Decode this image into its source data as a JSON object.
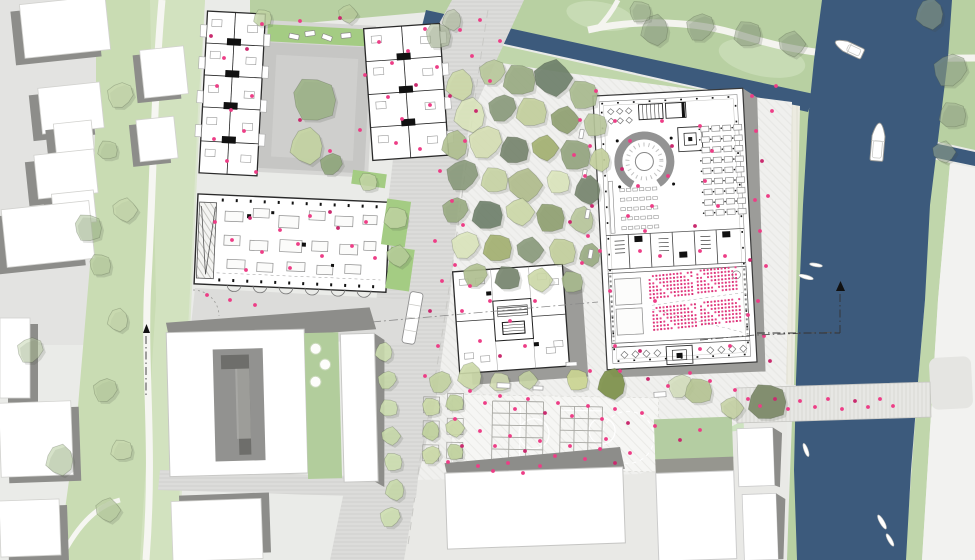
{
  "title": "urban-masterplan-site-plan",
  "colors": {
    "water": "#3c5a7c",
    "lawn_north": "#b8d0a2",
    "lawn_light": "#cfe0bf",
    "bank_south": "#c0d6ab",
    "green_strip": "#c9dcb3",
    "green_strip_light": "#d6e4c5",
    "bed_green": "#a4cc83",
    "lawn_se": "#cde3c0",
    "ground": "#eaebe8",
    "context_ground": "#e3e3e1",
    "bottom_ground": "#e9e9e6",
    "road_olive": "#a5a79c",
    "white_building": "#ffffff",
    "shadow": "#8d8d8a",
    "shadow_light": "#9c9c99",
    "courtyard_gray": "#c6c6c4",
    "courtyard_dark": "#6e6e6b",
    "roof_green": "#b4cda2",
    "people": "#ed3d86",
    "people_dark": "#c92a6e",
    "seat_a": "#e8488a",
    "seat_b": "#d92f75",
    "boat_fill": "#ffffff",
    "boat_stroke": "#9a9a96",
    "path_white": "#f6f6f2",
    "tree_shadow": "#44483e",
    "furniture_stroke": "#9a9a9a"
  },
  "trees": [
    [
      460,
      85,
      16,
      "#cdd9a8",
      0.9
    ],
    [
      492,
      72,
      14,
      "#b9c99b",
      0.9
    ],
    [
      520,
      80,
      18,
      "#99ab82",
      0.9
    ],
    [
      553,
      78,
      20,
      "#6e7f6a",
      0.9
    ],
    [
      583,
      95,
      16,
      "#a9ba8e",
      0.9
    ],
    [
      470,
      115,
      18,
      "#dce6bd",
      0.9
    ],
    [
      502,
      108,
      15,
      "#8a9a7b",
      0.9
    ],
    [
      532,
      112,
      17,
      "#c3cf9c",
      0.9
    ],
    [
      565,
      120,
      15,
      "#8fa070",
      0.9
    ],
    [
      595,
      125,
      13,
      "#b8c79b",
      0.9
    ],
    [
      455,
      145,
      15,
      "#b0c090",
      0.9
    ],
    [
      485,
      142,
      18,
      "#d6dfb4",
      0.9
    ],
    [
      515,
      150,
      16,
      "#75846d",
      0.9
    ],
    [
      545,
      148,
      14,
      "#a3b070",
      0.9
    ],
    [
      575,
      155,
      17,
      "#93a47e",
      0.9
    ],
    [
      600,
      160,
      12,
      "#c3cf9c",
      0.9
    ],
    [
      462,
      175,
      17,
      "#8a9a7b",
      0.9
    ],
    [
      495,
      180,
      15,
      "#c8d4a4",
      0.9
    ],
    [
      525,
      185,
      18,
      "#b0bd8c",
      0.9
    ],
    [
      558,
      182,
      13,
      "#dce6bd",
      0.9
    ],
    [
      588,
      190,
      15,
      "#75846d",
      0.9
    ],
    [
      455,
      210,
      14,
      "#99ab82",
      0.9
    ],
    [
      488,
      215,
      17,
      "#6e7f6a",
      0.9
    ],
    [
      520,
      212,
      15,
      "#cdd9a8",
      0.9
    ],
    [
      550,
      218,
      16,
      "#8fa070",
      0.9
    ],
    [
      582,
      220,
      14,
      "#b8c79b",
      0.9
    ],
    [
      465,
      245,
      15,
      "#dce6bd",
      0.9
    ],
    [
      498,
      248,
      16,
      "#a3b070",
      0.9
    ],
    [
      530,
      250,
      14,
      "#8a9a7b",
      0.9
    ],
    [
      562,
      252,
      15,
      "#c3cf9c",
      0.9
    ],
    [
      590,
      255,
      12,
      "#99ab82",
      0.9
    ],
    [
      475,
      275,
      13,
      "#b0c090",
      0.9
    ],
    [
      508,
      278,
      14,
      "#75846d",
      0.9
    ],
    [
      540,
      280,
      13,
      "#cdd9a8",
      0.9
    ],
    [
      572,
      282,
      12,
      "#a9ba8e",
      0.9
    ],
    [
      655,
      30,
      16,
      "#93a488",
      0.55
    ],
    [
      700,
      27,
      15,
      "#93a488",
      0.5
    ],
    [
      748,
      34,
      15,
      "#8f9f84",
      0.5
    ],
    [
      792,
      44,
      14,
      "#93a488",
      0.5
    ],
    [
      640,
      12,
      12,
      "#a2b194",
      0.45
    ],
    [
      930,
      14,
      16,
      "#9aa98c",
      0.5
    ],
    [
      950,
      70,
      18,
      "#96a78a",
      0.55
    ],
    [
      953,
      115,
      15,
      "#9aa98c",
      0.5
    ],
    [
      944,
      152,
      12,
      "#a2b194",
      0.5
    ],
    [
      438,
      36,
      14,
      "#a8b896",
      0.6
    ],
    [
      452,
      20,
      11,
      "#b2c19e",
      0.55
    ],
    [
      120,
      95,
      14,
      "#c7d8ae",
      0.75
    ],
    [
      108,
      150,
      11,
      "#b9cda1",
      0.75
    ],
    [
      125,
      210,
      13,
      "#c7d8ae",
      0.75
    ],
    [
      100,
      265,
      12,
      "#b9cda1",
      0.75
    ],
    [
      118,
      320,
      12,
      "#c7d8ae",
      0.75
    ],
    [
      105,
      390,
      13,
      "#b9cda1",
      0.75
    ],
    [
      122,
      450,
      12,
      "#c7d8ae",
      0.75
    ],
    [
      108,
      510,
      13,
      "#b9cda1",
      0.75
    ],
    [
      88,
      228,
      15,
      "#a3bb8e",
      0.5
    ],
    [
      60,
      460,
      16,
      "#aec694",
      0.5
    ],
    [
      30,
      350,
      14,
      "#b7cc9f",
      0.45
    ],
    [
      263,
      18,
      10,
      "#c2d4a4",
      0.8
    ],
    [
      348,
      14,
      10,
      "#bccf9e",
      0.7
    ],
    [
      314,
      100,
      24,
      "#9cb287",
      0.9
    ],
    [
      307,
      146,
      19,
      "#c4d4a2",
      0.9
    ],
    [
      331,
      164,
      12,
      "#90a67c",
      0.9
    ],
    [
      396,
      218,
      13,
      "#bed3a0",
      0.9
    ],
    [
      398,
      256,
      12,
      "#b5cc98",
      0.9
    ],
    [
      368,
      182,
      10,
      "#c4d6a6",
      0.85
    ],
    [
      470,
      376,
      14,
      "#ccd9a8",
      0.9
    ],
    [
      440,
      382,
      12,
      "#c2d2a0",
      0.9
    ],
    [
      500,
      382,
      11,
      "#d2ddb2",
      0.85
    ],
    [
      528,
      380,
      10,
      "#c6d4a2",
      0.85
    ],
    [
      577,
      380,
      12,
      "#ccd692",
      0.9
    ],
    [
      612,
      384,
      16,
      "#81934f",
      0.95
    ],
    [
      680,
      386,
      13,
      "#d4debc",
      0.85
    ],
    [
      699,
      391,
      15,
      "#b6c493",
      0.9
    ],
    [
      732,
      408,
      12,
      "#c2cf9e",
      0.8
    ],
    [
      431,
      407,
      10,
      "#cbd9a6",
      0.9
    ],
    [
      431,
      431,
      10,
      "#c0d29c",
      0.9
    ],
    [
      431,
      455,
      10,
      "#cbd9a6",
      0.9
    ],
    [
      455,
      403,
      10,
      "#c0d29c",
      0.9
    ],
    [
      455,
      428,
      10,
      "#cbd9a6",
      0.9
    ],
    [
      455,
      452,
      9,
      "#c0d29c",
      0.9
    ],
    [
      384,
      352,
      10,
      "#cfe0b0",
      0.85
    ],
    [
      387,
      380,
      10,
      "#c8dba8",
      0.85
    ],
    [
      389,
      408,
      10,
      "#cfe0b0",
      0.85
    ],
    [
      391,
      436,
      10,
      "#c8dba8",
      0.85
    ],
    [
      393,
      462,
      10,
      "#cfe0b0",
      0.85
    ],
    [
      395,
      490,
      11,
      "#c8dba8",
      0.85
    ],
    [
      390,
      517,
      11,
      "#cfe0b0",
      0.85
    ],
    [
      768,
      402,
      21,
      "#7d8a6a",
      0.95
    ]
  ],
  "people": [
    [
      211,
      36
    ],
    [
      224,
      58
    ],
    [
      217,
      86
    ],
    [
      231,
      110
    ],
    [
      214,
      139
    ],
    [
      227,
      161
    ],
    [
      247,
      49
    ],
    [
      252,
      96
    ],
    [
      244,
      131
    ],
    [
      256,
      172
    ],
    [
      262,
      24
    ],
    [
      300,
      21
    ],
    [
      340,
      18
    ],
    [
      379,
      42
    ],
    [
      392,
      63
    ],
    [
      408,
      51
    ],
    [
      388,
      97
    ],
    [
      402,
      119
    ],
    [
      416,
      85
    ],
    [
      430,
      105
    ],
    [
      396,
      143
    ],
    [
      420,
      149
    ],
    [
      437,
      67
    ],
    [
      425,
      29
    ],
    [
      300,
      120
    ],
    [
      330,
      151
    ],
    [
      360,
      130
    ],
    [
      365,
      75
    ],
    [
      215,
      222
    ],
    [
      232,
      240
    ],
    [
      250,
      218
    ],
    [
      262,
      252
    ],
    [
      280,
      230
    ],
    [
      298,
      244
    ],
    [
      310,
      216
    ],
    [
      322,
      256
    ],
    [
      338,
      228
    ],
    [
      352,
      246
    ],
    [
      366,
      222
    ],
    [
      375,
      258
    ],
    [
      290,
      268
    ],
    [
      246,
      270
    ],
    [
      330,
      212
    ],
    [
      207,
      295
    ],
    [
      230,
      300
    ],
    [
      255,
      305
    ],
    [
      460,
      30
    ],
    [
      472,
      56
    ],
    [
      450,
      96
    ],
    [
      465,
      141
    ],
    [
      440,
      171
    ],
    [
      452,
      201
    ],
    [
      435,
      241
    ],
    [
      442,
      281
    ],
    [
      430,
      311
    ],
    [
      438,
      346
    ],
    [
      425,
      376
    ],
    [
      480,
      20
    ],
    [
      500,
      41
    ],
    [
      490,
      81
    ],
    [
      476,
      111
    ],
    [
      455,
      265
    ],
    [
      463,
      225
    ],
    [
      580,
      120
    ],
    [
      590,
      146
    ],
    [
      585,
      176
    ],
    [
      592,
      206
    ],
    [
      588,
      236
    ],
    [
      582,
      263
    ],
    [
      596,
      91
    ],
    [
      600,
      251
    ],
    [
      574,
      155
    ],
    [
      570,
      222
    ],
    [
      470,
      391
    ],
    [
      485,
      403
    ],
    [
      500,
      396
    ],
    [
      515,
      409
    ],
    [
      528,
      399
    ],
    [
      545,
      413
    ],
    [
      558,
      403
    ],
    [
      572,
      416
    ],
    [
      588,
      406
    ],
    [
      602,
      419
    ],
    [
      615,
      409
    ],
    [
      628,
      423
    ],
    [
      642,
      413
    ],
    [
      655,
      426
    ],
    [
      480,
      431
    ],
    [
      495,
      446
    ],
    [
      510,
      436
    ],
    [
      525,
      451
    ],
    [
      540,
      441
    ],
    [
      555,
      456
    ],
    [
      570,
      446
    ],
    [
      585,
      459
    ],
    [
      600,
      449
    ],
    [
      615,
      463
    ],
    [
      630,
      453
    ],
    [
      478,
      466
    ],
    [
      493,
      471
    ],
    [
      508,
      463
    ],
    [
      523,
      473
    ],
    [
      462,
      446
    ],
    [
      448,
      462
    ],
    [
      455,
      419
    ],
    [
      606,
      439
    ],
    [
      540,
      466
    ],
    [
      756,
      131
    ],
    [
      762,
      161
    ],
    [
      768,
      196
    ],
    [
      760,
      231
    ],
    [
      766,
      266
    ],
    [
      758,
      301
    ],
    [
      764,
      336
    ],
    [
      770,
      361
    ],
    [
      752,
      96
    ],
    [
      772,
      111
    ],
    [
      776,
      86
    ],
    [
      748,
      399
    ],
    [
      760,
      406
    ],
    [
      775,
      399
    ],
    [
      788,
      409
    ],
    [
      800,
      401
    ],
    [
      815,
      407
    ],
    [
      828,
      399
    ],
    [
      842,
      409
    ],
    [
      855,
      401
    ],
    [
      868,
      407
    ],
    [
      880,
      399
    ],
    [
      893,
      406
    ],
    [
      615,
      121
    ],
    [
      630,
      141
    ],
    [
      622,
      169
    ],
    [
      638,
      186
    ],
    [
      652,
      206
    ],
    [
      628,
      216
    ],
    [
      645,
      231
    ],
    [
      662,
      121
    ],
    [
      672,
      146
    ],
    [
      668,
      176
    ],
    [
      700,
      126
    ],
    [
      712,
      151
    ],
    [
      705,
      181
    ],
    [
      718,
      206
    ],
    [
      695,
      226
    ],
    [
      640,
      251
    ],
    [
      660,
      256
    ],
    [
      700,
      251
    ],
    [
      725,
      256
    ],
    [
      615,
      346
    ],
    [
      640,
      351
    ],
    [
      700,
      349
    ],
    [
      730,
      346
    ],
    [
      655,
      301
    ],
    [
      610,
      291
    ],
    [
      755,
      200
    ],
    [
      750,
      260
    ],
    [
      748,
      315
    ],
    [
      470,
      286
    ],
    [
      490,
      301
    ],
    [
      510,
      321
    ],
    [
      480,
      341
    ],
    [
      500,
      356
    ],
    [
      525,
      346
    ],
    [
      462,
      311
    ],
    [
      535,
      301
    ],
    [
      590,
      371
    ],
    [
      620,
      371
    ],
    [
      648,
      379
    ],
    [
      668,
      386
    ],
    [
      690,
      373
    ],
    [
      710,
      381
    ],
    [
      735,
      390
    ],
    [
      700,
      430
    ],
    [
      680,
      440
    ]
  ],
  "benches": [
    [
      497,
      383,
      13,
      5,
      2
    ],
    [
      533,
      386,
      10,
      4,
      2
    ],
    [
      654,
      392,
      12,
      5,
      -3
    ],
    [
      566,
      362,
      11,
      4,
      -3
    ],
    [
      577,
      132,
      9,
      4,
      -80
    ],
    [
      580,
      172,
      9,
      4,
      -80
    ],
    [
      583,
      212,
      9,
      4,
      -80
    ],
    [
      586,
      252,
      9,
      4,
      -80
    ]
  ],
  "cars": [
    [
      289,
      34,
      10,
      5,
      12
    ],
    [
      305,
      31,
      10,
      5,
      -8
    ],
    [
      322,
      35,
      10,
      5,
      20
    ],
    [
      341,
      33,
      10,
      5,
      -5
    ]
  ],
  "beds": [
    [
      384,
      200,
      24,
      46,
      8
    ],
    [
      388,
      248,
      24,
      42,
      8
    ],
    [
      352,
      172,
      34,
      14,
      8
    ]
  ],
  "context_buildings": [
    {
      "x": 22,
      "y": 0,
      "w": 86,
      "h": 54,
      "rot": -6,
      "ox": -9,
      "oy": 7
    },
    {
      "x": 40,
      "y": 85,
      "w": 62,
      "h": 46,
      "rot": -6,
      "ox": -9,
      "oy": 7
    },
    {
      "x": 55,
      "y": 122,
      "w": 38,
      "h": 34,
      "rot": -6,
      "ox": -8,
      "oy": 6
    },
    {
      "x": 36,
      "y": 152,
      "w": 60,
      "h": 44,
      "rot": -6,
      "ox": -9,
      "oy": 7
    },
    {
      "x": 53,
      "y": 192,
      "w": 42,
      "h": 32,
      "rot": -6,
      "ox": -8,
      "oy": 6
    },
    {
      "x": 4,
      "y": 205,
      "w": 88,
      "h": 58,
      "rot": -6,
      "ox": -9,
      "oy": 7
    },
    {
      "x": 142,
      "y": 48,
      "w": 44,
      "h": 48,
      "rot": -6,
      "ox": -7,
      "oy": 5
    },
    {
      "x": 138,
      "y": 118,
      "w": 38,
      "h": 42,
      "rot": -6,
      "ox": -7,
      "oy": 5
    },
    {
      "x": 0,
      "y": 318,
      "w": 30,
      "h": 80,
      "rot": 0,
      "ox": 8,
      "oy": 6
    },
    {
      "x": 0,
      "y": 402,
      "w": 72,
      "h": 74,
      "rot": -2,
      "ox": 8,
      "oy": 6
    },
    {
      "x": 0,
      "y": 500,
      "w": 60,
      "h": 56,
      "rot": -2,
      "ox": 8,
      "oy": 6
    },
    {
      "x": 172,
      "y": 500,
      "w": 90,
      "h": 60,
      "rot": -2,
      "ox": 8,
      "oy": -6
    }
  ],
  "boats": [
    {
      "x": 849,
      "y": 48,
      "rot": 205,
      "l": 30,
      "w": 11
    },
    {
      "x": 878,
      "y": 142,
      "rot": 275,
      "l": 38,
      "w": 13
    }
  ],
  "kayaks": [
    {
      "x": 806,
      "y": 277,
      "rot": 15,
      "l": 15,
      "w": 4
    },
    {
      "x": 816,
      "y": 265,
      "rot": 10,
      "l": 13,
      "w": 3.5
    },
    {
      "x": 806,
      "y": 450,
      "rot": 70,
      "l": 14,
      "w": 4
    },
    {
      "x": 882,
      "y": 522,
      "rot": 60,
      "l": 16,
      "w": 4.5
    },
    {
      "x": 890,
      "y": 540,
      "rot": 60,
      "l": 14,
      "w": 4
    }
  ],
  "auditorium_seat_blocks": [
    {
      "x": 646,
      "y": 274,
      "cols": 13,
      "rows": 7,
      "dx": 3.5,
      "dy": 3.6
    },
    {
      "x": 694,
      "y": 271,
      "cols": 12,
      "rows": 7,
      "dx": 3.5,
      "dy": 3.6
    },
    {
      "x": 648,
      "y": 306,
      "cols": 13,
      "rows": 7,
      "dx": 3.5,
      "dy": 3.6
    },
    {
      "x": 696,
      "y": 303,
      "cols": 12,
      "rows": 7,
      "dx": 3.5,
      "dy": 3.6
    }
  ],
  "desk_grid": {
    "x": 706,
    "y": 128,
    "cols": 4,
    "rows": 9,
    "dx": 11,
    "dy": 10.5,
    "w": 8,
    "h": 5.5
  },
  "reading_rows": {
    "x": 622,
    "y": 186,
    "rows": 5,
    "cols": 6,
    "dx": 6.5,
    "dy": 9.5,
    "w": 4.5,
    "h": 3
  }
}
